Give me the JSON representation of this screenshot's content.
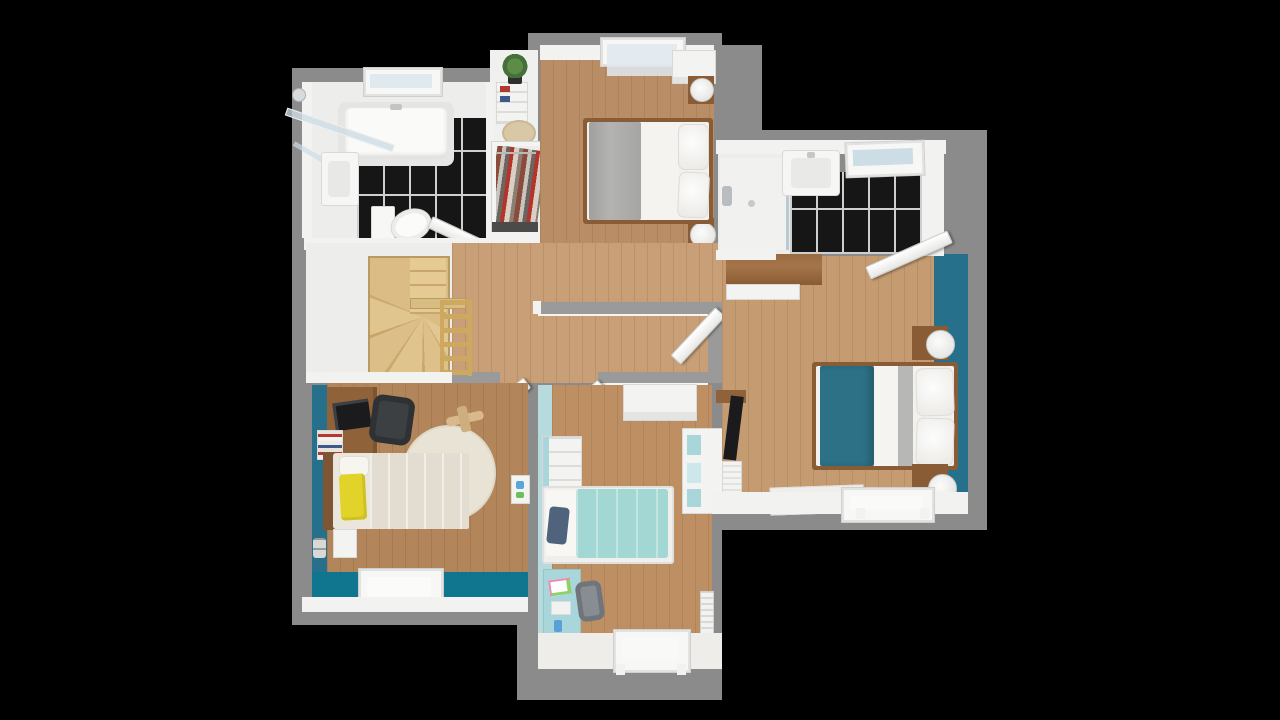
{
  "meta": {
    "kind": "3d-floorplan-render",
    "view": "top-down",
    "background_is_black": true
  },
  "palette": {
    "bg": "#000000",
    "shell": "#8b8b8b",
    "wallcap": "#9a9a9a",
    "wall_white": "#f2f2f0",
    "floor_white": "#ededeb",
    "tile_black": "#161616",
    "grout": "#cfcfcf",
    "glass": "#dfe9ee",
    "wood_hall": "#c89f76",
    "wood_top": "#b98e66",
    "wood_left": "#b2855a",
    "wood_child": "#bd8f63",
    "wood_master": "#c59b71",
    "stair_light": "#e0c28a",
    "stair_dark": "#c9a76c",
    "rail": "#cfa860",
    "teal_floor": "#10758f",
    "teal_wall": "#26708b",
    "teal_blanket": "#2d7186",
    "aqua_wall": "#b7dadd",
    "aqua_item": "#a9d6da",
    "aqua_blanket": "#a2d7d3",
    "navy": "#4f637d",
    "yellow": "#e2d32a",
    "brown": "#8f6239",
    "bed_frame": "#8a5c36",
    "blanket_gray": "#a9a9a7",
    "duvet": "#f3f1ec",
    "cream_rug": "#e8e3d5",
    "dark": "#1b1b1d"
  },
  "rooms": {
    "bathroom": {
      "label": "family bathroom",
      "floor": "black tile + white",
      "items": [
        "corner shower with glass screen",
        "bathtub",
        "washbasin",
        "toilet",
        "top window",
        "door"
      ]
    },
    "closet": {
      "label": "walk-in closet nook",
      "items": [
        "shelf unit",
        "plant",
        "round rug",
        "open wardrobe with hanging clothes"
      ]
    },
    "bedroom_top": {
      "label": "bedroom with gray bed",
      "items": [
        "double bed, gray blanket, white pillows",
        "two nightstands with round lamps",
        "white wardrobe",
        "top window",
        "door"
      ]
    },
    "stairs": {
      "label": "stair landing",
      "items": [
        "winder staircase",
        "wood railing"
      ]
    },
    "hallway": {
      "label": "hallway",
      "items": [
        "four open doors",
        "partition walls"
      ]
    },
    "bedroom_left": {
      "label": "bedroom with yellow pillow",
      "items": [
        "desk with laptop",
        "office chair",
        "book stack",
        "round cream rug",
        "toy plane",
        "bed with yellow pillow",
        "teal accent wall",
        "bottom window"
      ]
    },
    "bedroom_child": {
      "label": "child bedroom",
      "items": [
        "white sideboard",
        "white dresser",
        "bed with aqua blanket and navy pillow",
        "cube bookcase",
        "aqua desk with chair",
        "radiator",
        "bottom window"
      ]
    },
    "bedroom_master": {
      "label": "master bedroom",
      "items": [
        "wood dresser",
        "wall TV unit",
        "double bed with teal blanket",
        "two nightstands with round lamps",
        "teal accent wall",
        "white rug",
        "bottom window"
      ]
    },
    "ensuite": {
      "label": "ensuite bathroom",
      "items": [
        "walk-in shower",
        "washbasin",
        "black tile floor",
        "skylight window",
        "door"
      ]
    }
  }
}
